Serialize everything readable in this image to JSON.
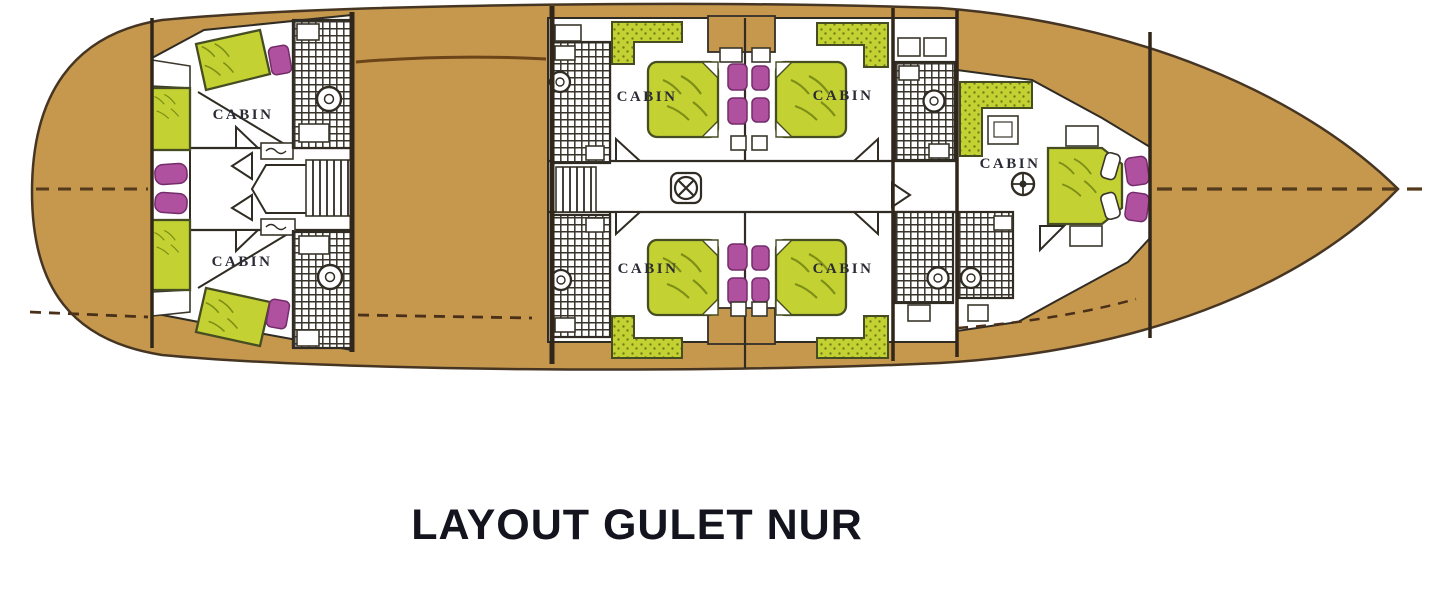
{
  "title": "LAYOUT GULET NUR",
  "diagram": {
    "vessel_name": "Gulet Nur",
    "view": "lower deck cabin plan, bow facing right",
    "cabin_labels": [
      "CABIN",
      "CABIN",
      "CABIN",
      "CABIN",
      "CABIN",
      "CABIN",
      "CABIN"
    ],
    "counts": {
      "cabins": 7,
      "bathrooms": 7,
      "stairways": 2,
      "double_beds": 5,
      "twin_berth_cabins": 2
    },
    "icons": {
      "deck_hatch": "circled-x-icon",
      "helm_station": "ships-wheel-icon",
      "toilet": "toilet-circle-icon",
      "shower": "shower-circle-icon",
      "stairs": "ladder-rungs-icon",
      "door": "door-swing-triangle-icon"
    },
    "colors": {
      "background": "#ffffff",
      "deck_wood": "#c6984e",
      "hull_outline": "#463522",
      "room_fill": "#ffffff",
      "wall_dark": "#302c24",
      "bed_green": "#c3d232",
      "upholstery_magenta": "#b0519f",
      "centerline_brown": "#533a1b",
      "label_text": "#2b2b36",
      "title_text": "#14141f"
    }
  }
}
